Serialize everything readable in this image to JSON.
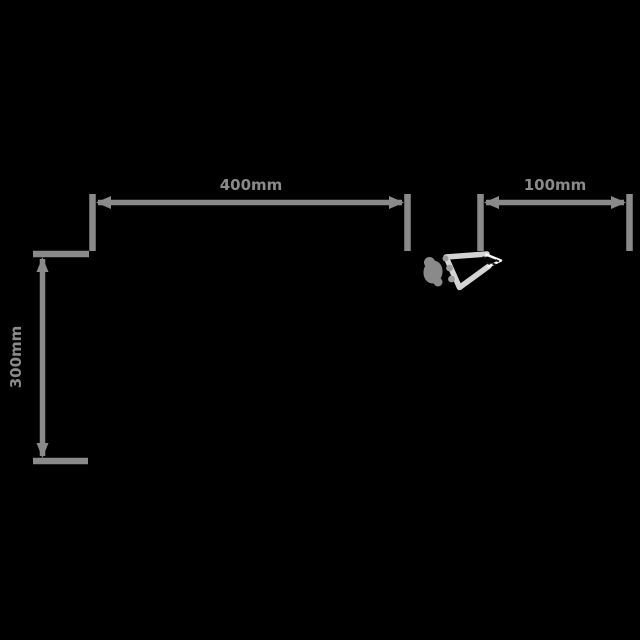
{
  "diagram": {
    "labels": {
      "width": "400mm",
      "depth": "100mm",
      "height": "300mm"
    },
    "colors": {
      "background": "#000000",
      "dimension_line": "#8a8a8a",
      "label_text": "#8a8a8a",
      "shape_outline_light": "#d4d4d4",
      "shape_tip_highlight": "#f8f8f8",
      "shape_bracket_gray": "#8a8a8a",
      "shape_detail_dark": "#151515"
    }
  }
}
